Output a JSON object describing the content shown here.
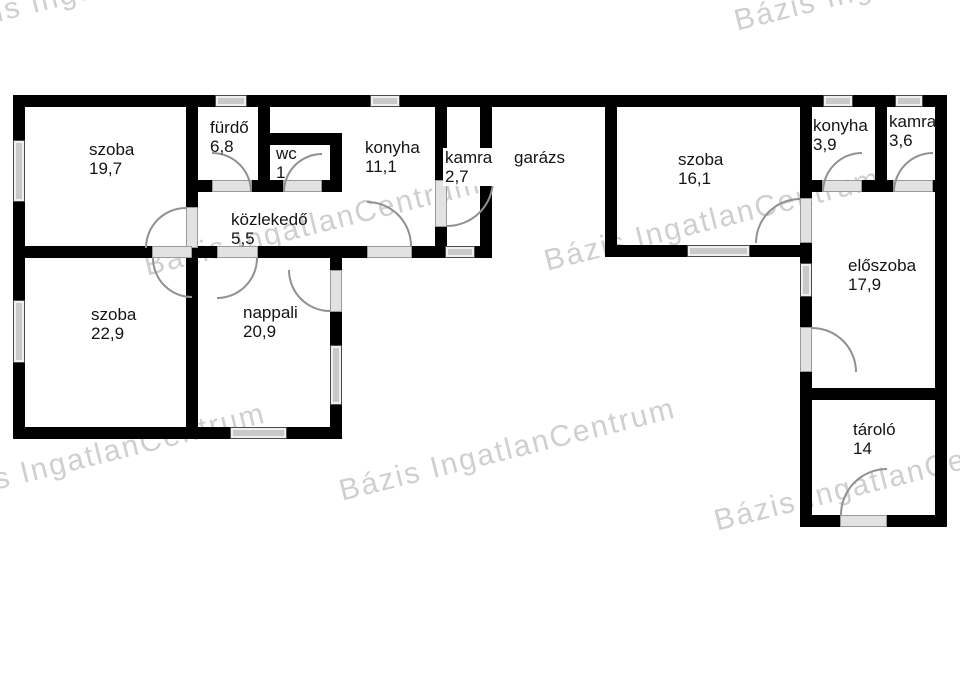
{
  "plan": {
    "background": "#ffffff",
    "wall_color": "#000000",
    "window_color": "#c9c9c9",
    "door_arc_color": "#909090"
  },
  "watermark": {
    "text": "Bázis IngatlanCentrum",
    "color": "#c0c0c0",
    "instances": [
      {
        "x": -60,
        "y": 10
      },
      {
        "x": 735,
        "y": 5
      },
      {
        "x": 145,
        "y": 250
      },
      {
        "x": 545,
        "y": 245
      },
      {
        "x": -70,
        "y": 480
      },
      {
        "x": 340,
        "y": 475
      },
      {
        "x": 715,
        "y": 505
      }
    ]
  },
  "rooms": [
    {
      "id": "szoba-197",
      "name": "szoba",
      "area": "19,7",
      "x": 89,
      "y": 140
    },
    {
      "id": "furdo",
      "name": "fürdő",
      "area": "6,8",
      "x": 210,
      "y": 118
    },
    {
      "id": "wc",
      "name": "wc",
      "area": "1",
      "x": 276,
      "y": 144
    },
    {
      "id": "konyha-111",
      "name": "konyha",
      "area": "11,1",
      "x": 365,
      "y": 138
    },
    {
      "id": "kamra-27",
      "name": "kamra",
      "area": "2,7",
      "x": 443,
      "y": 148,
      "bg": "white"
    },
    {
      "id": "garazs",
      "name": "garázs",
      "area": "",
      "x": 514,
      "y": 148
    },
    {
      "id": "szoba-161",
      "name": "szoba",
      "area": "16,1",
      "x": 678,
      "y": 150
    },
    {
      "id": "konyha-39",
      "name": "konyha",
      "area": "3,9",
      "x": 813,
      "y": 116
    },
    {
      "id": "kamra-36",
      "name": "kamra",
      "area": "3,6",
      "x": 889,
      "y": 112
    },
    {
      "id": "kozlekedo",
      "name": "közlekedő",
      "area": "5,5",
      "x": 231,
      "y": 210
    },
    {
      "id": "szoba-229",
      "name": "szoba",
      "area": "22,9",
      "x": 91,
      "y": 305
    },
    {
      "id": "nappali",
      "name": "nappali",
      "area": "20,9",
      "x": 243,
      "y": 303
    },
    {
      "id": "eloszoba",
      "name": "előszoba",
      "area": "17,9",
      "x": 848,
      "y": 256
    },
    {
      "id": "tarolo",
      "name": "tároló",
      "area": "14",
      "x": 853,
      "y": 420
    }
  ]
}
